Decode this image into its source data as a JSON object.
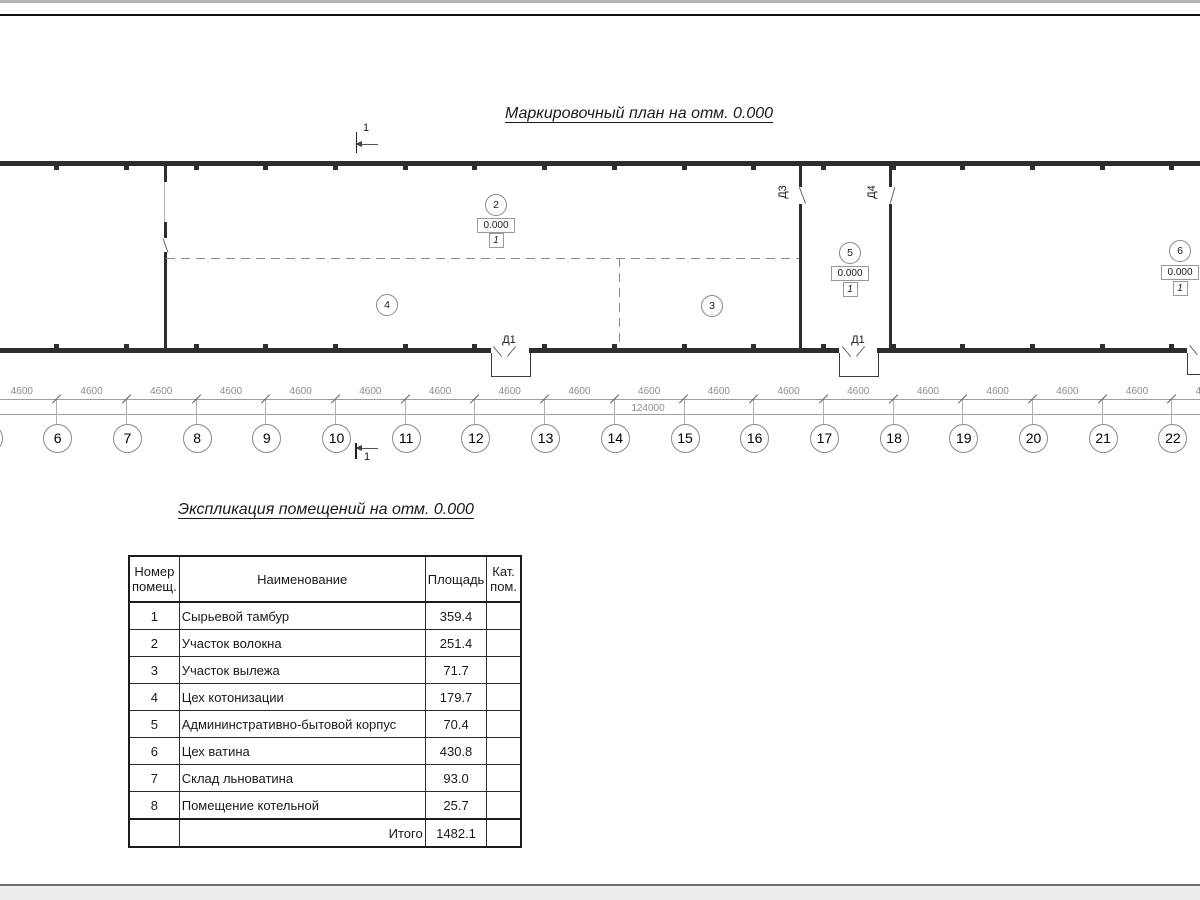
{
  "page": {
    "plan_title": "Маркировочный план на отм. 0.000",
    "table_title": "Экспликация помещений на отм. 0.000"
  },
  "plan": {
    "section_mark_label": "1",
    "axis_labels": [
      "6",
      "7",
      "8",
      "9",
      "10",
      "11",
      "12",
      "13",
      "14",
      "15",
      "16",
      "17",
      "18",
      "19",
      "20",
      "21",
      "22"
    ],
    "bay_dimension": "4600",
    "total_dimension": "124000",
    "rooms": [
      {
        "number": "2",
        "elevation": "0.000",
        "floor_type": "1"
      },
      {
        "number": "3",
        "elevation": "",
        "floor_type": ""
      },
      {
        "number": "4",
        "elevation": "",
        "floor_type": ""
      },
      {
        "number": "5",
        "elevation": "0.000",
        "floor_type": "1"
      },
      {
        "number": "6",
        "elevation": "0.000",
        "floor_type": "1"
      }
    ],
    "door_labels": {
      "d1": "Д1",
      "d3": "Д3",
      "d4": "Д4"
    }
  },
  "table": {
    "headers": {
      "number": "Номер помещ.",
      "name": "Наименование",
      "area": "Площадь",
      "category": "Кат. пом."
    },
    "rows": [
      {
        "number": "1",
        "name": "Сырьевой тамбур",
        "area": "359.4",
        "category": ""
      },
      {
        "number": "2",
        "name": "Участок волокна",
        "area": "251.4",
        "category": ""
      },
      {
        "number": "3",
        "name": "Участок вылежа",
        "area": "71.7",
        "category": ""
      },
      {
        "number": "4",
        "name": "Цех котонизации",
        "area": "179.7",
        "category": ""
      },
      {
        "number": "5",
        "name": "Админинстративно-бытовой корпус",
        "area": "70.4",
        "category": ""
      },
      {
        "number": "6",
        "name": "Цех ватина",
        "area": "430.8",
        "category": ""
      },
      {
        "number": "7",
        "name": "Склад льноватина",
        "area": "93.0",
        "category": ""
      },
      {
        "number": "8",
        "name": "Помещение котельной",
        "area": "25.7",
        "category": ""
      }
    ],
    "total_label": "Итого",
    "total_area": "1482.1"
  }
}
